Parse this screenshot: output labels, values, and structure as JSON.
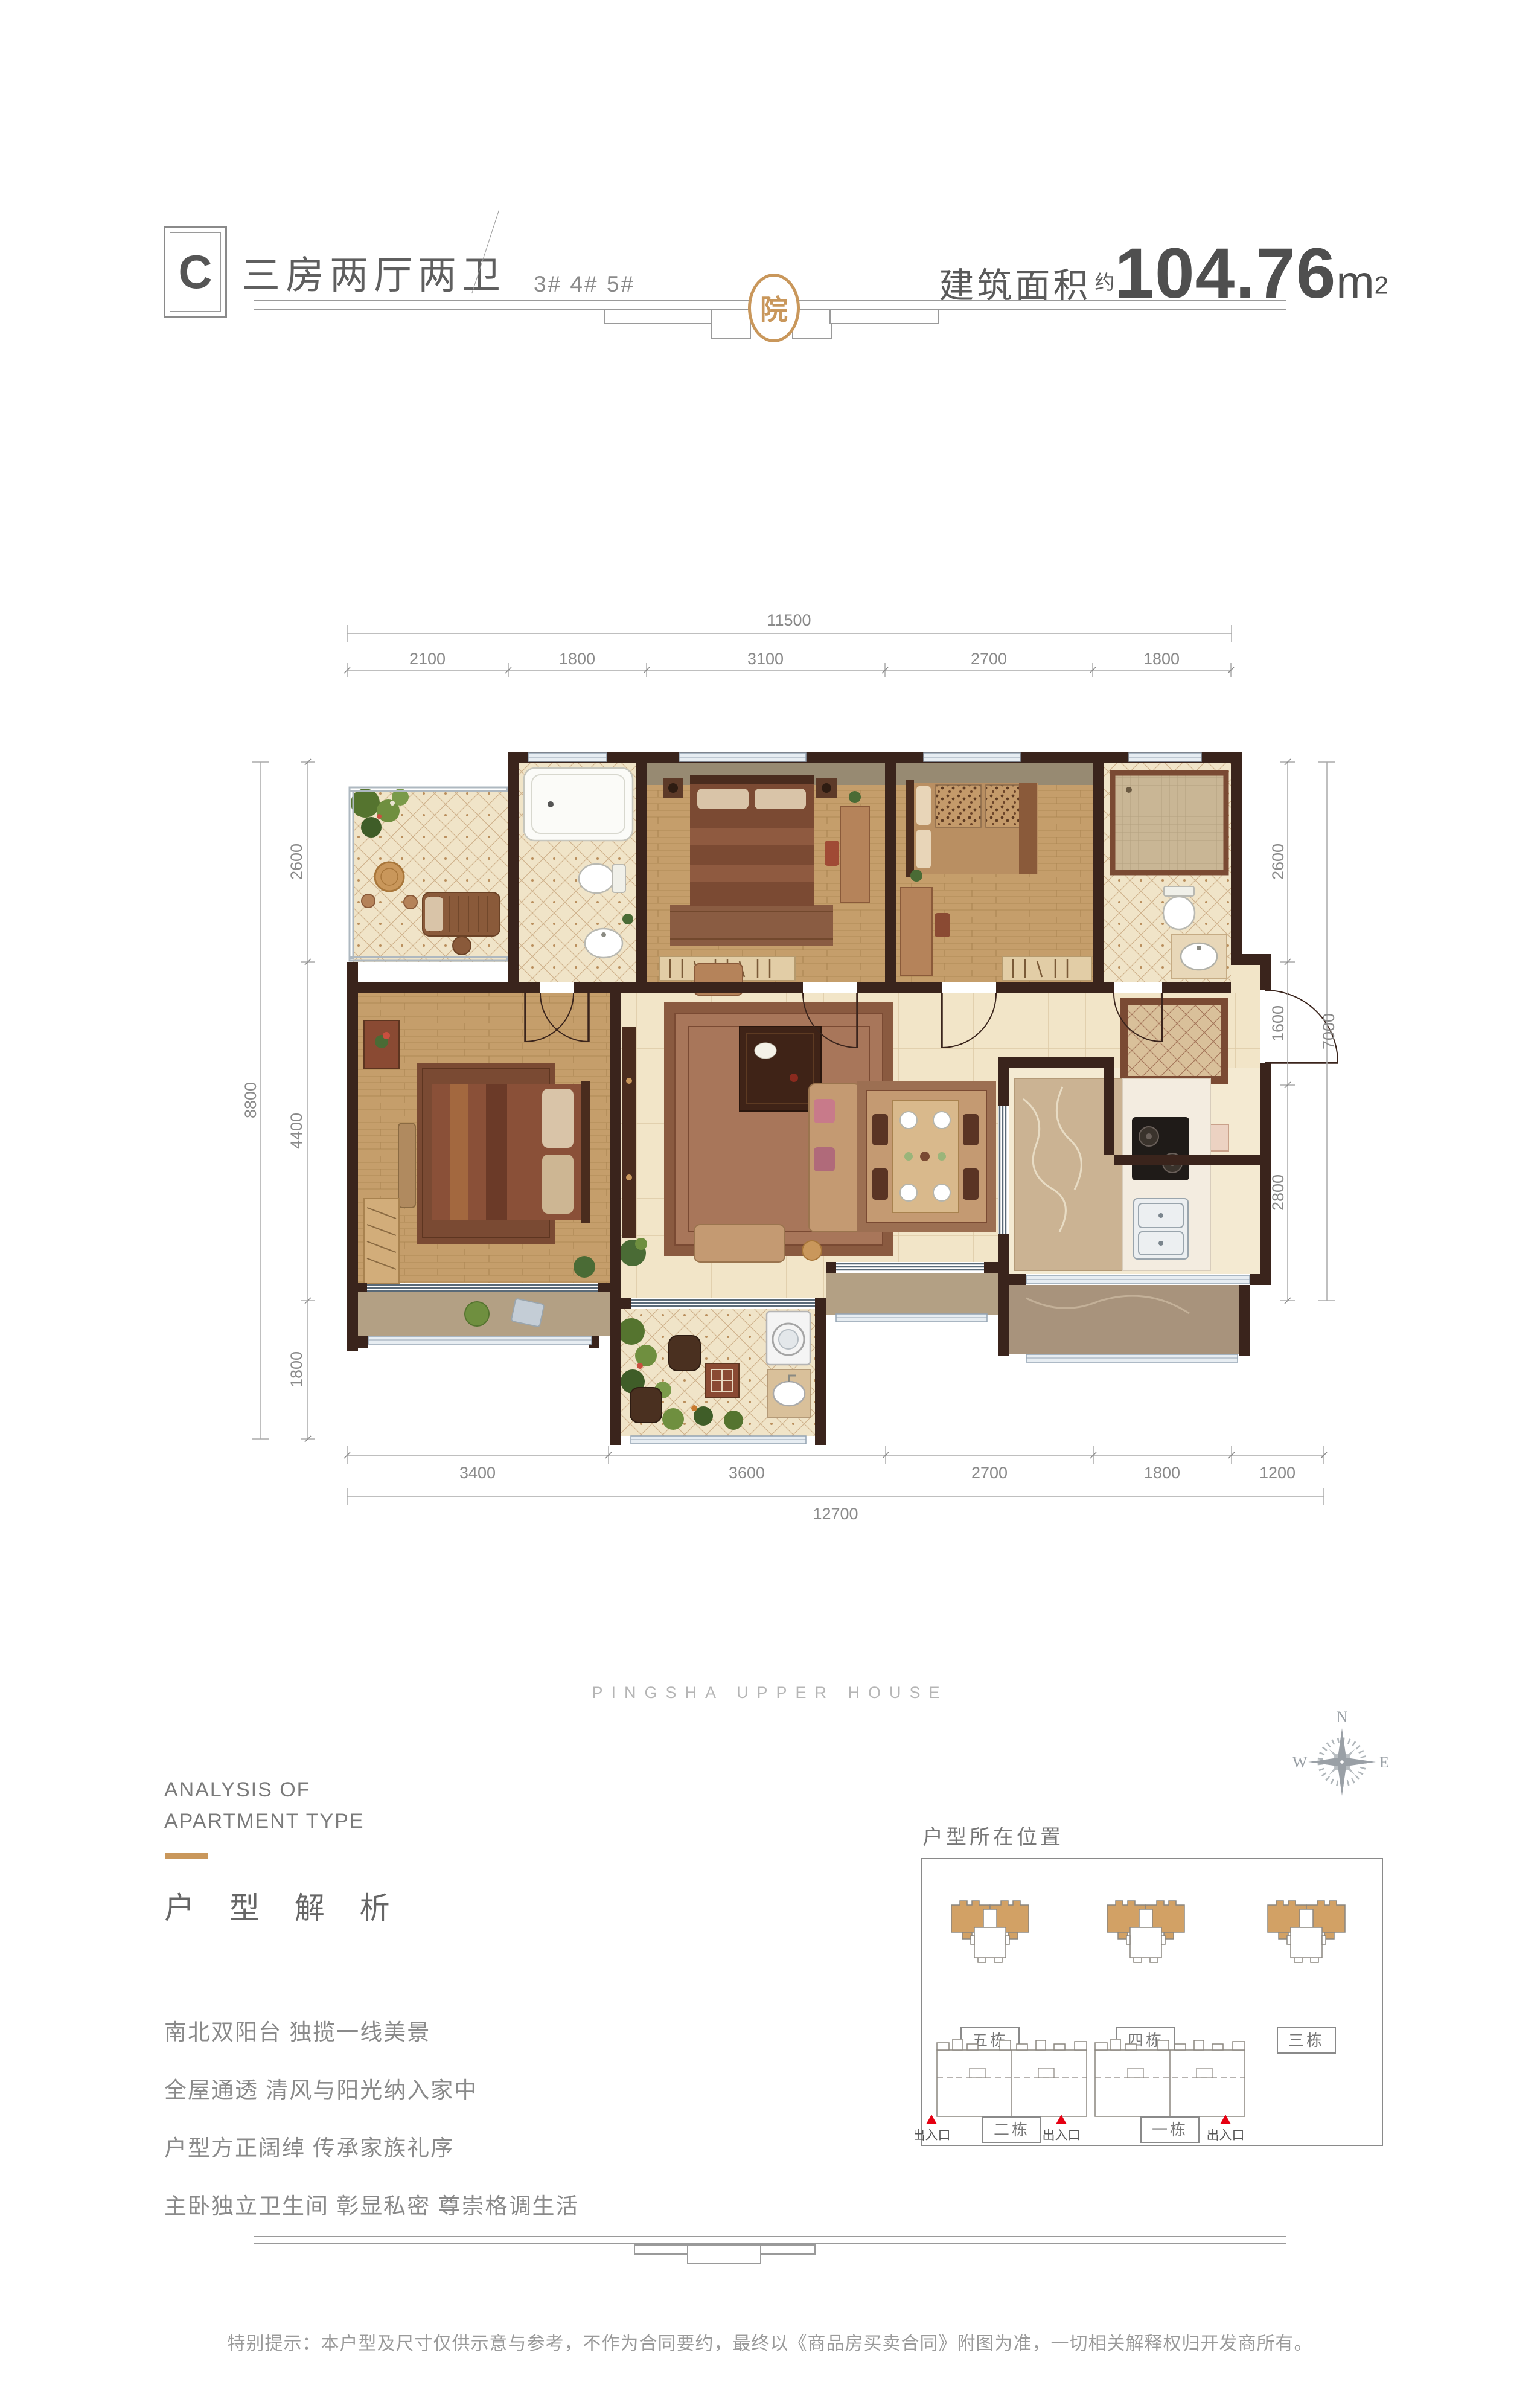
{
  "header": {
    "type_code": "C",
    "type_name": "三房两厅两卫",
    "building_numbers": "3# 4# 5#",
    "area_label": "建筑面积",
    "area_prefix": "约",
    "area_value": "104.76",
    "area_unit": "m",
    "area_unit_exponent": "2"
  },
  "seal_character": "院",
  "floor_plan": {
    "dimensions": {
      "top": {
        "total": "11500",
        "segments": [
          "2100",
          "1800",
          "3100",
          "2700",
          "1800"
        ]
      },
      "bottom": {
        "total": "12700",
        "segments": [
          "3400",
          "3600",
          "2700",
          "1800",
          "1200"
        ]
      },
      "left": {
        "total": "8800",
        "segments": [
          "2600",
          "4400",
          "1800"
        ]
      },
      "right": {
        "total": "7000",
        "segments": [
          "2600",
          "1600",
          "2800"
        ]
      }
    }
  },
  "watermark": "PINGSHA UPPER HOUSE",
  "compass": {
    "north": "N",
    "west": "W",
    "east": "E"
  },
  "analysis": {
    "english_line1": "ANALYSIS OF",
    "english_line2": "APARTMENT TYPE",
    "chinese_title": "户 型 解 析",
    "selling_points": [
      "南北双阳台 独揽一线美景",
      "全屋通透 清风与阳光纳入家中",
      "户型方正阔绰 传承家族礼序",
      "主卧独立卫生间 彰显私密 尊崇格调生活"
    ]
  },
  "location_map": {
    "title": "户型所在位置",
    "top_row_buildings": [
      "五栋",
      "四栋",
      "三栋"
    ],
    "bottom_row_buildings": [
      "二栋",
      "一栋"
    ],
    "entrance_label": "出入口"
  },
  "disclaimer": "特别提示：本户型及尺寸仅供示意与参考，不作为合同要约，最终以《商品房买卖合同》附图为准，一切相关解释权归开发商所有。",
  "colors": {
    "accent_gold": "#C9975B",
    "wall_brown": "#3A241C",
    "entrance_red": "#E60012"
  }
}
